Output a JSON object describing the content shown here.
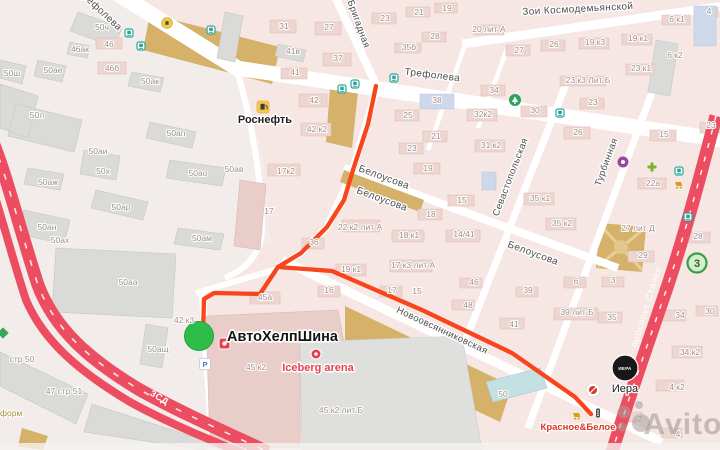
{
  "colors": {
    "map_background": "#f7e7e4",
    "industrial_zone": "#f2edea",
    "residential_building": "#edd5d0",
    "industrial_building": "#dadad8",
    "khaki_area": "#d5b169",
    "highway_red": "#ed4d60",
    "route_red": "#f8451c",
    "marker_green": "#2ebc4b",
    "transit_teal": "#2aa79b",
    "badge_green": "#379f47",
    "watermark_gray": "#a89d9a"
  },
  "streets": [
    "Трефолева",
    "Трефолева",
    "Зои Космодемьянской",
    "Бригадная",
    "Белоусова",
    "Белоусова",
    "Белоусова",
    "Севастопольская",
    "Турбинная",
    "Новоовсянниковская",
    "проспект Стачек",
    "ЗСД"
  ],
  "pois": {
    "rosneft": "Роснефть",
    "avtohelpshina": "АвтоХелпШина",
    "iceberg_arena": "Iceberg arena",
    "krasnoe_beloe": "Красное&Белое",
    "iera": "Иера",
    "iera_logo": "ИЕРА"
  },
  "badges": {
    "route_3": "3",
    "parking": "P"
  },
  "watermark": "Avito",
  "building_labels": [
    "50ч",
    "50ш",
    "50ае",
    "46ак",
    "46",
    "46б",
    "50ак",
    "50л",
    "50ап",
    "50аи",
    "50х",
    "50аж",
    "50ао",
    "50ав",
    "50ар",
    "50ан",
    "50ах",
    "50ам",
    "50аа",
    "50ащ",
    "стр 50",
    "47 стр 51",
    "форм",
    "31",
    "27",
    "23",
    "21",
    "19",
    "28",
    "35б",
    "37",
    "41в",
    "41",
    "42",
    "42 к2",
    "38",
    "25",
    "21",
    "23",
    "19",
    "32к2",
    "31 к2",
    "30",
    "34",
    "15",
    "18",
    "35 к1",
    "35 к2",
    "26",
    "27",
    "20 лит А",
    "19 к3",
    "19 к1",
    "6 к1",
    "6 к2",
    "4",
    "23 к1",
    "23 к3 Лит Б",
    "23",
    "26",
    "15",
    "22а",
    "27 лит Д",
    "29",
    "28",
    "3",
    "6",
    "39",
    "18 к1",
    "14/41",
    "19 к1",
    "22 к2 лит А",
    "36",
    "17к2",
    "17",
    "17 к3 лит А",
    "17",
    "15",
    "16",
    "46",
    "48",
    "45а",
    "39 лит Б",
    "41",
    "35",
    "50",
    "34",
    "34 к2",
    "4 к2",
    "2",
    "4",
    "30",
    "45 к2",
    "45 к2 лит Б",
    "42 к3",
    "23"
  ]
}
